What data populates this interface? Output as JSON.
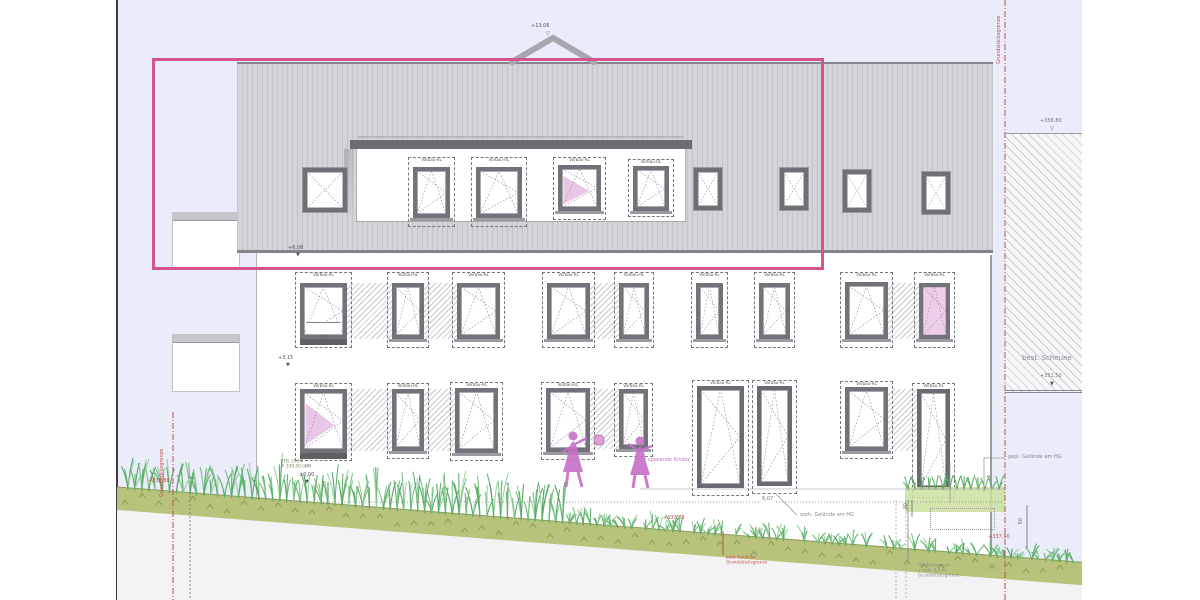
{
  "labels": {
    "window_shutter": "Vorbau-RL",
    "window_fixed": "fest"
  },
  "markers": {
    "ridge": "+13,06",
    "eaves": "+6,08",
    "upper_floor": "+3,15",
    "zero": "±0,00",
    "ffl_line1": "EFB ±0,00",
    "ffl_line2": "≙ 339,50 üNN",
    "grade_left": "+338,88",
    "grade_mid": "+337,85",
    "grade_right": "+337,90",
    "barn_top": "+356,80",
    "barn_bottom": "+351,50",
    "dim_total": "6,07",
    "dim_right_upper": "30",
    "dim_right_lower": "50"
  },
  "notes": {
    "boundary_left": "Grundstücksgrenze",
    "boundary_right": "Grundstücksgrenze",
    "boundary_note_line1": "best. bauliche",
    "boundary_note_line2": "Grundstücksgrenze",
    "retaining_line1": "OK Stützmauer",
    "retaining_line2": "+ evtl. 0,4 m",
    "retaining_line3": "Grundstücksgrenze",
    "grade_existing": "vorh. Gelände am HG",
    "grade_planned": "gepl. Gelände am HG",
    "barn": "best. Scheune",
    "kids": "spielende Kinder"
  },
  "icons": {
    "level_marker_open": "▽",
    "level_marker_filled": "▼"
  },
  "colors": {
    "highlight_box": "#d4558e",
    "boundary_line": "#c0504d",
    "figure_pink": "#c76ec7",
    "grass": "#55a963",
    "ground_band": "#b9c27b",
    "window_pink": "#e5b8e0",
    "sky": "#eaedf9",
    "roof": "#d4d4d8"
  }
}
